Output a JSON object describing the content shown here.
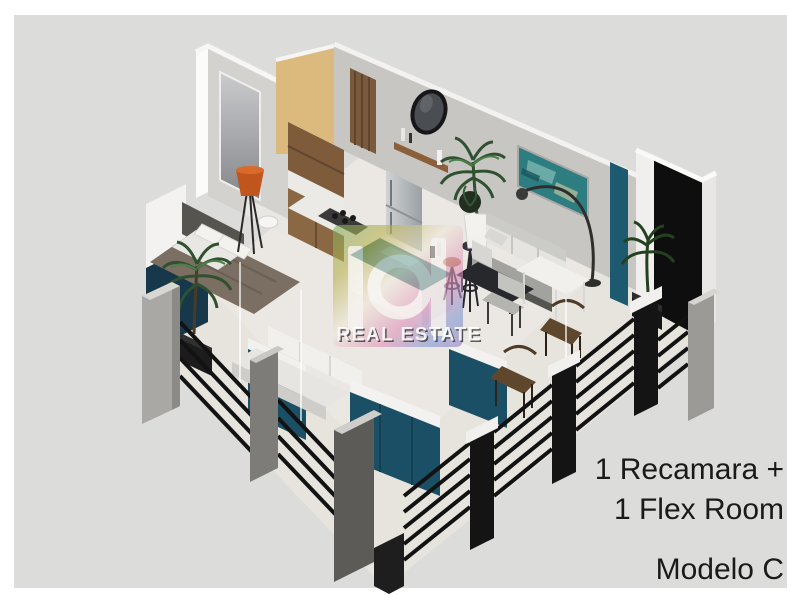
{
  "image": {
    "kind": "3d-isometric-apartment-floorplan-render",
    "canvas_background": "#dcdcdb",
    "frame_color": "#ffffff"
  },
  "caption": {
    "line1": "1 Recamara +",
    "line2": "1 Flex Room",
    "model": "Modelo C",
    "text_color": "#1a1a1a"
  },
  "watermark": {
    "label": "REAL ESTATE",
    "palette": [
      "#7fae62",
      "#b9b04f",
      "#efe8d9",
      "#e08fb8",
      "#7f97d4",
      "#9478c0"
    ],
    "text_color": "#ffffff"
  },
  "palette": {
    "floor": "#ebe8e3",
    "wall_light": "#f3f2f0",
    "wall_gray": "#c7c6c3",
    "beige_wall": "#dcb97c",
    "wood": "#7d5b3b",
    "teal_accent": "#1b4f66",
    "teal_strip": "#1d5a70",
    "navy_panel": "#16384a",
    "black_wall": "#0e0e0e",
    "railing_black": "#121212",
    "concrete_post": "#a9a8a5",
    "duvet_taupe": "#7b6e62",
    "lamp_orange": "#c0561e",
    "plant_green": "#2f5130",
    "art_teal": "#2e7e81"
  },
  "scene": {
    "objects": [
      "bathroom-mirror-wall",
      "beige-accent-wall",
      "wood-slat-door",
      "round-wall-mirror",
      "wood-wall-shelf",
      "kitchen-cabinets",
      "refrigerator",
      "gas-cooktop",
      "kitchen-island",
      "bar-stools",
      "tall-palm-plant",
      "teal-wall-art",
      "arc-floor-lamp",
      "living-sofa",
      "coffee-table",
      "dining-chair",
      "white-dining-table",
      "wicker-chairs",
      "corner-palm-plant",
      "black-accent-wall",
      "teal-accent-strip",
      "bedroom-bed",
      "bed-pillows",
      "headboard",
      "orange-floor-lamp",
      "navy-exterior-panel",
      "balcony-palm-plant",
      "flex-room-sofa",
      "teal-partition-panels",
      "glass-partitions",
      "concrete-fence-posts",
      "metal-balcony-railing"
    ]
  }
}
